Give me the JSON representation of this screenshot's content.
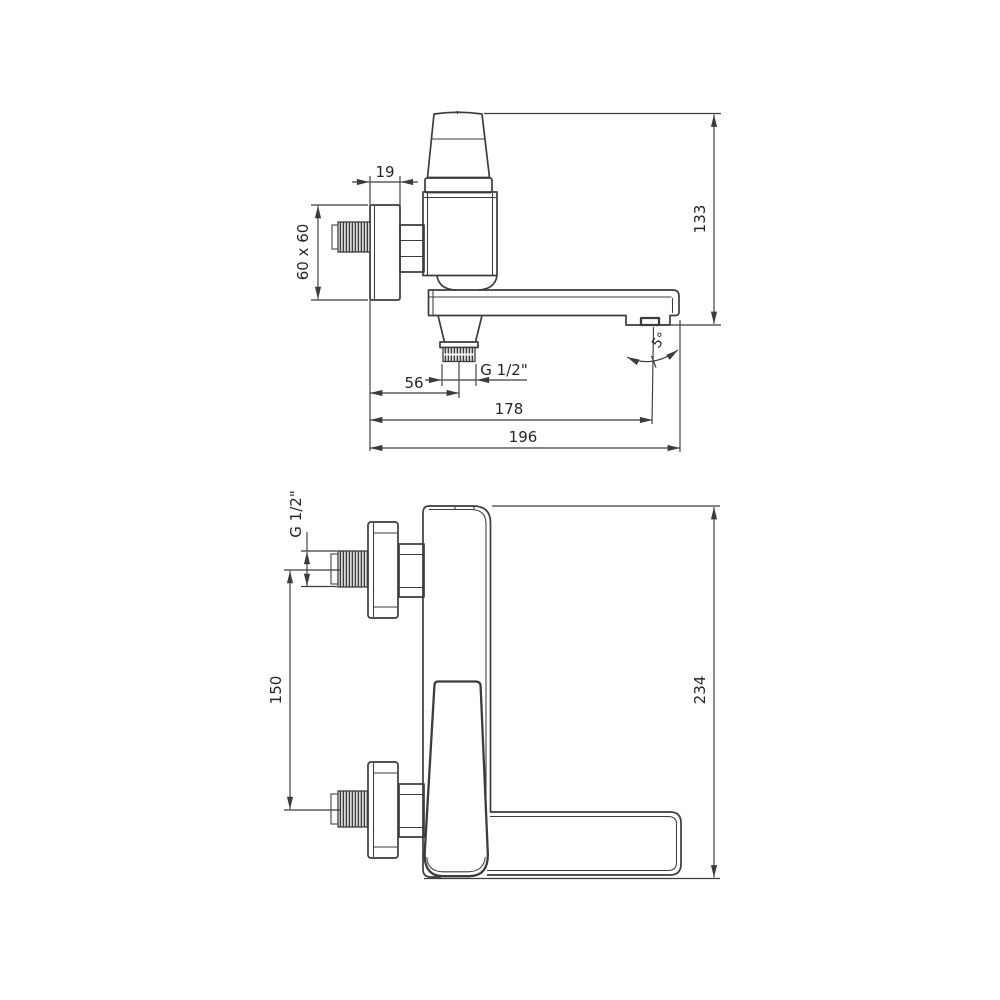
{
  "drawing": {
    "title": "faucet-dimension-drawing",
    "colors": {
      "line": "#3c3c3c",
      "text": "#262626",
      "background": "#ffffff"
    },
    "side": {
      "plate_depth": "19",
      "plate_size": "60 x 60",
      "height": "133",
      "outlet_thread": "G 1/2\"",
      "outlet_offset": "56",
      "reach": "178",
      "total_depth": "196",
      "spout_angle": "5°"
    },
    "front": {
      "inlet_thread": "G 1/2\"",
      "inlet_spacing": "150",
      "total_height": "234"
    }
  }
}
